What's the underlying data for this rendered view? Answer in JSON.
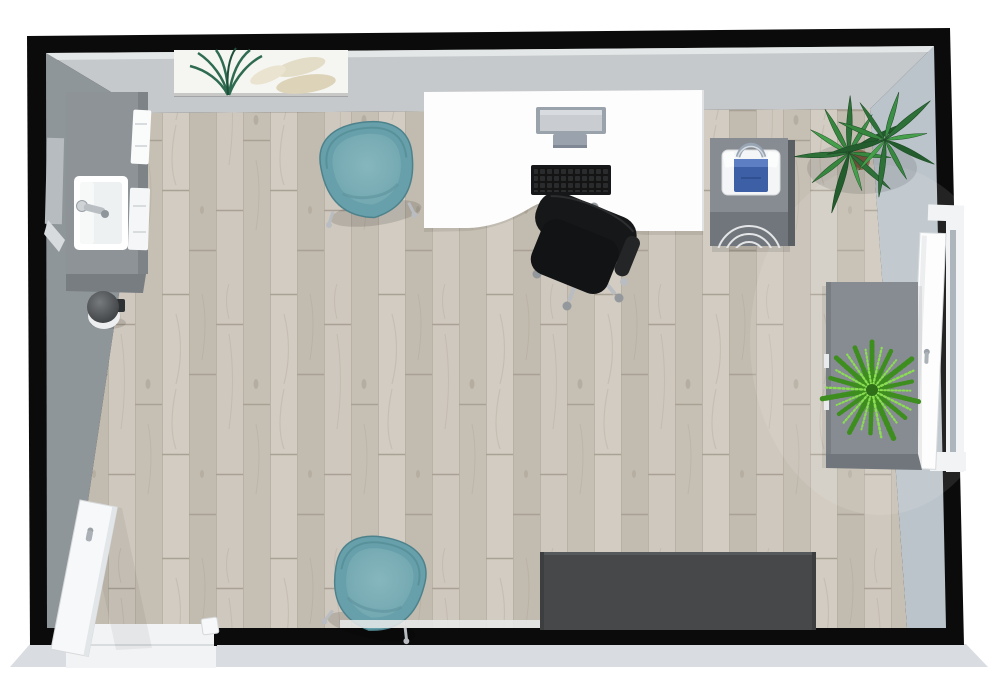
{
  "scene": {
    "title": "3D top-down office floor plan render",
    "view": "top-down 3D",
    "colors": {
      "wall-dark": "#0b0b0b",
      "face-top": "#c6c9cb",
      "face-left": "#8f969a",
      "face-right": "#bcc4cb",
      "bevel": "#d9dce0",
      "floor-base": "#d3ccc1",
      "floor-gap": "#b8afa2",
      "desk": "#fdfdfd",
      "teal": "#67a0aa",
      "teal-light": "#7db0b8",
      "sofa": "#46484a",
      "cabinet": "#868c91",
      "cabinet-dark": "#70767b",
      "sink-gray": "#8e9397",
      "chair-black": "#161718",
      "chrome": "#b9bdc1",
      "window-white": "#f1f3f4",
      "door-white": "#f7f8f9",
      "bag-blue": "#3c5fa6",
      "plant-green": "#2f7a3c",
      "fern-green": "#55ae2b",
      "art-beige": "#ded5bc"
    },
    "furniture": {
      "floor": {
        "label": "Light oak plank floor"
      },
      "walls": {
        "label": "Room walls"
      },
      "vanity": {
        "label": "Sink vanity with basin and faucet"
      },
      "mirror": {
        "label": "Wall mirror"
      },
      "towels": {
        "label": "Hand towels"
      },
      "bin": {
        "label": "Round waste bin"
      },
      "artwork": {
        "label": "Leaf wall art"
      },
      "chair_top": {
        "label": "Teal tub chair"
      },
      "chair_bottom": {
        "label": "Teal tub chair"
      },
      "desk": {
        "label": "White office desk with ergonomic cutout"
      },
      "monitor": {
        "label": "Computer monitor"
      },
      "keyboard": {
        "label": "Keyboard"
      },
      "task_chair": {
        "label": "Black swivel desk chair"
      },
      "pedestal": {
        "label": "Drawer pedestal"
      },
      "bag": {
        "label": "Blue tote bag"
      },
      "yucca": {
        "label": "Potted yucca plant"
      },
      "sideboard": {
        "label": "Gray storage cabinet"
      },
      "fern": {
        "label": "Potted fern"
      },
      "window": {
        "label": "Open casement window"
      },
      "bench": {
        "label": "Dark gray bench seat"
      },
      "door": {
        "label": "White entry door, open"
      },
      "baseboard": {
        "label": "Floor trim strip"
      }
    }
  }
}
